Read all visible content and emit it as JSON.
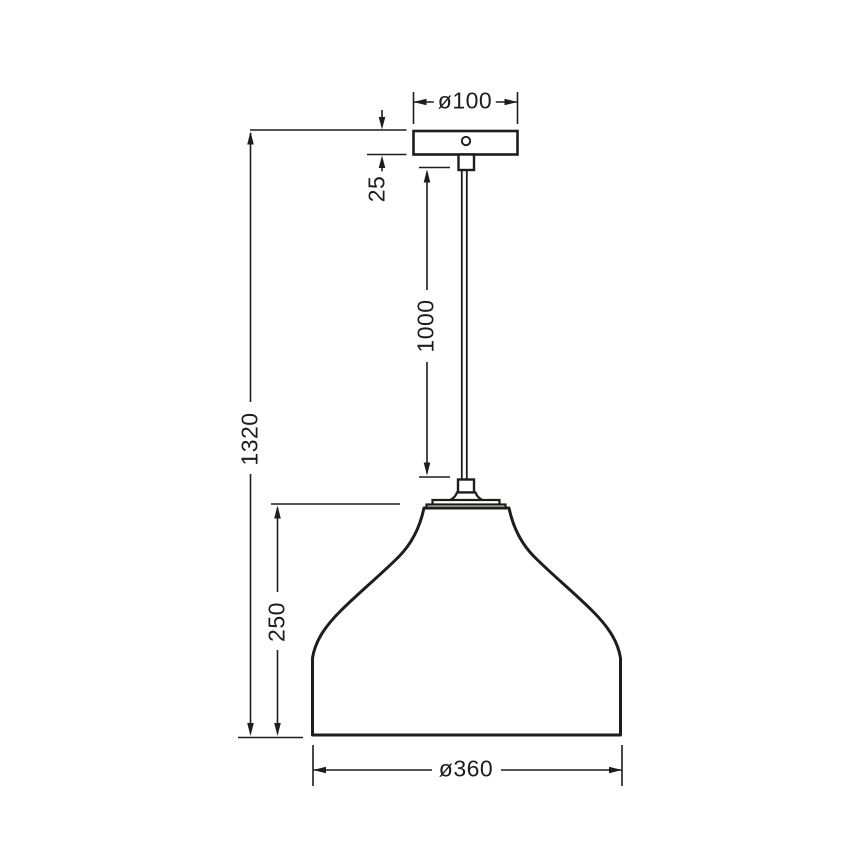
{
  "diagram": {
    "type": "technical-dimension-drawing",
    "subject": "pendant lamp with bell-shaped shade, suspension cable and ceiling canopy",
    "line_color": "#1d1d1b",
    "background_color": "#ffffff",
    "labels": {
      "canopy_diameter": "ø100",
      "canopy_height": "25",
      "cable_length": "1000",
      "overall_height": "1320",
      "shade_height": "250",
      "shade_diameter": "ø360"
    }
  }
}
